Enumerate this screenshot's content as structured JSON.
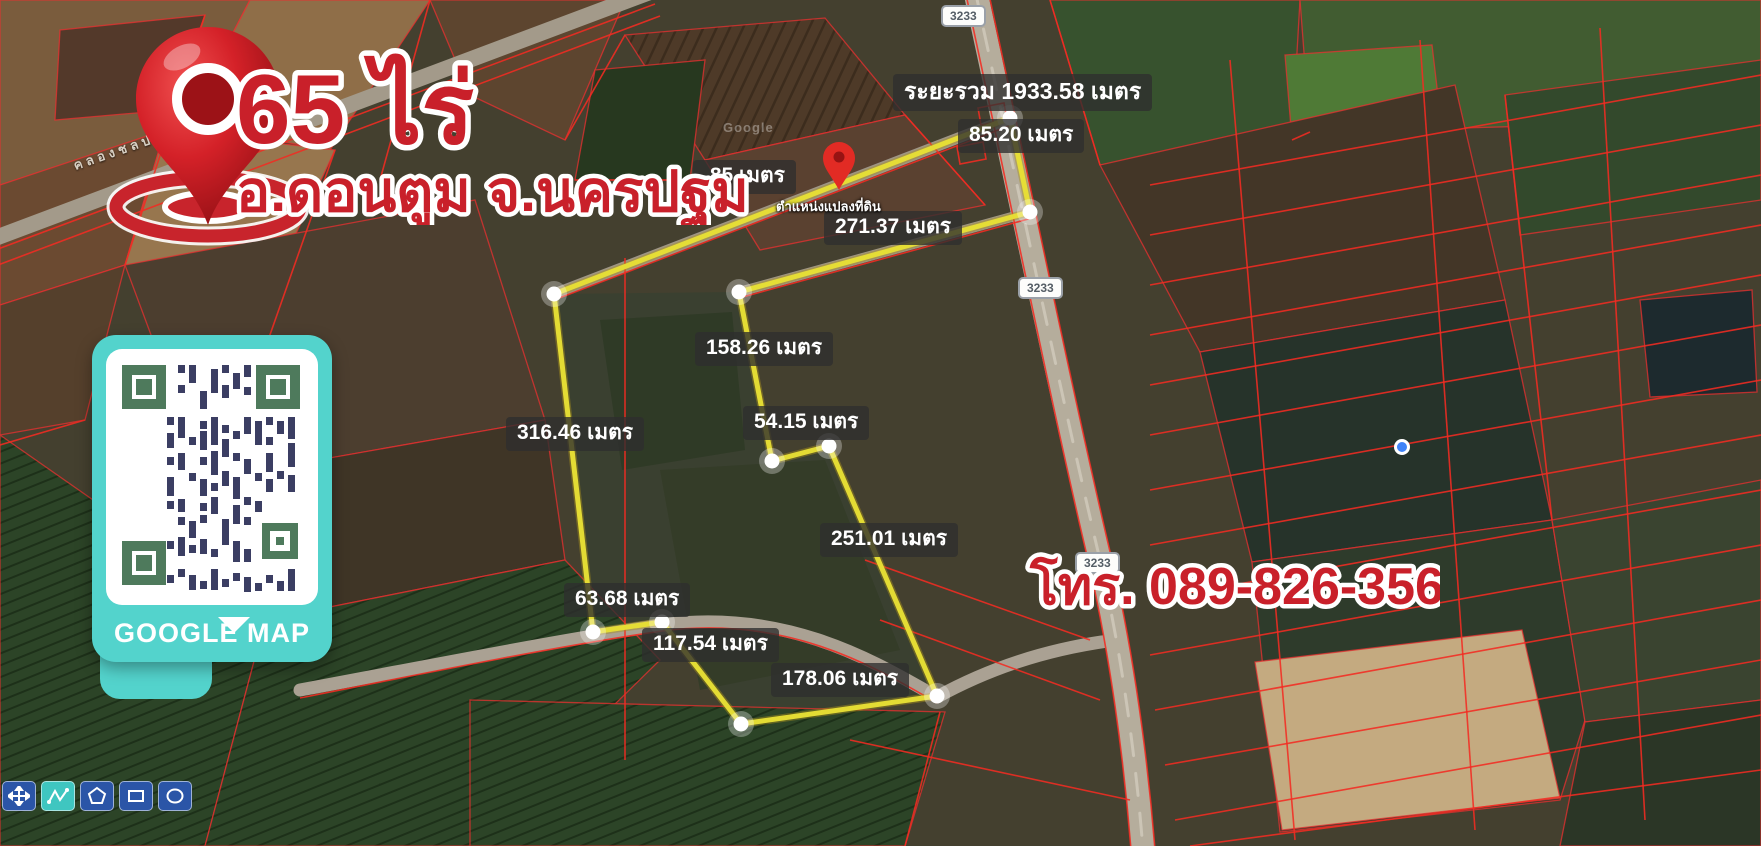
{
  "title": {
    "area": "65 ไร่",
    "location": "อ.ดอนตูม จ.นครปฐม"
  },
  "contact": {
    "phone": "โทร. 089-826-3563"
  },
  "qr_card": {
    "caption": "GOOGLE MAP"
  },
  "summary": {
    "total_distance": "ระยะรวม 1933.58 เมตร"
  },
  "plot_marker": {
    "caption": "ตำแหน่งแปลงที่ดิน"
  },
  "measurements": [
    {
      "text": "85.20 เมตร"
    },
    {
      "text": ".85 เมตร"
    },
    {
      "text": "271.37 เมตร"
    },
    {
      "text": "158.26 เมตร"
    },
    {
      "text": "54.15 เมตร"
    },
    {
      "text": "316.46 เมตร"
    },
    {
      "text": "251.01 เมตร"
    },
    {
      "text": "63.68 เมตร"
    },
    {
      "text": "117.54 เมตร"
    },
    {
      "text": "178.06 เมตร"
    }
  ],
  "road_badges": [
    {
      "label": "3233"
    },
    {
      "label": "3233"
    },
    {
      "label": "3233"
    }
  ],
  "map_labels": {
    "road_name": "คลองชลประทาน",
    "watermark": "Google"
  },
  "toolbar": {
    "tools": [
      {
        "name": "pan"
      },
      {
        "name": "freehand-measure"
      },
      {
        "name": "polygon"
      },
      {
        "name": "rectangle"
      },
      {
        "name": "circle"
      }
    ]
  },
  "colors": {
    "accent_red": "#c9202a",
    "boundary_yellow": "#e7df35",
    "card_teal": "#53d3cc",
    "cadastral_red": "#ff2a2a",
    "label_bg": "rgba(46,46,46,0.78)"
  }
}
